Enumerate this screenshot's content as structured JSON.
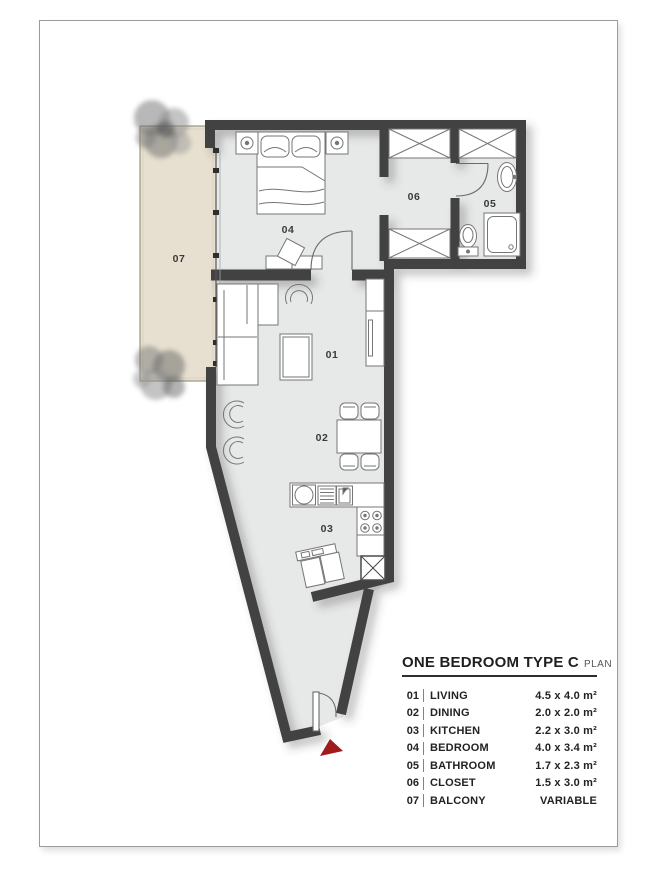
{
  "legend": {
    "title": "ONE BEDROOM TYPE C",
    "subtitle": "PLAN",
    "items": [
      {
        "num": "01",
        "name": "LIVING",
        "size": "4.5 x 4.0 m²"
      },
      {
        "num": "02",
        "name": "DINING",
        "size": "2.0 x 2.0 m²"
      },
      {
        "num": "03",
        "name": "KITCHEN",
        "size": "2.2 x 3.0 m²"
      },
      {
        "num": "04",
        "name": "BEDROOM",
        "size": "4.0 x 3.4 m²"
      },
      {
        "num": "05",
        "name": "BATHROOM",
        "size": "1.7 x 2.3 m²"
      },
      {
        "num": "06",
        "name": "CLOSET",
        "size": "1.5 x 3.0 m²"
      },
      {
        "num": "07",
        "name": "BALCONY",
        "size": "VARIABLE"
      }
    ]
  },
  "plan": {
    "room_labels": [
      "01",
      "02",
      "03",
      "04",
      "05",
      "06",
      "07"
    ],
    "colors": {
      "wall": "#434343",
      "floor": "#e7e8e8",
      "balcony": "#e7e0d0",
      "entry_arrow": "#9e1c1c",
      "legend_divider": "#b5705e"
    }
  }
}
